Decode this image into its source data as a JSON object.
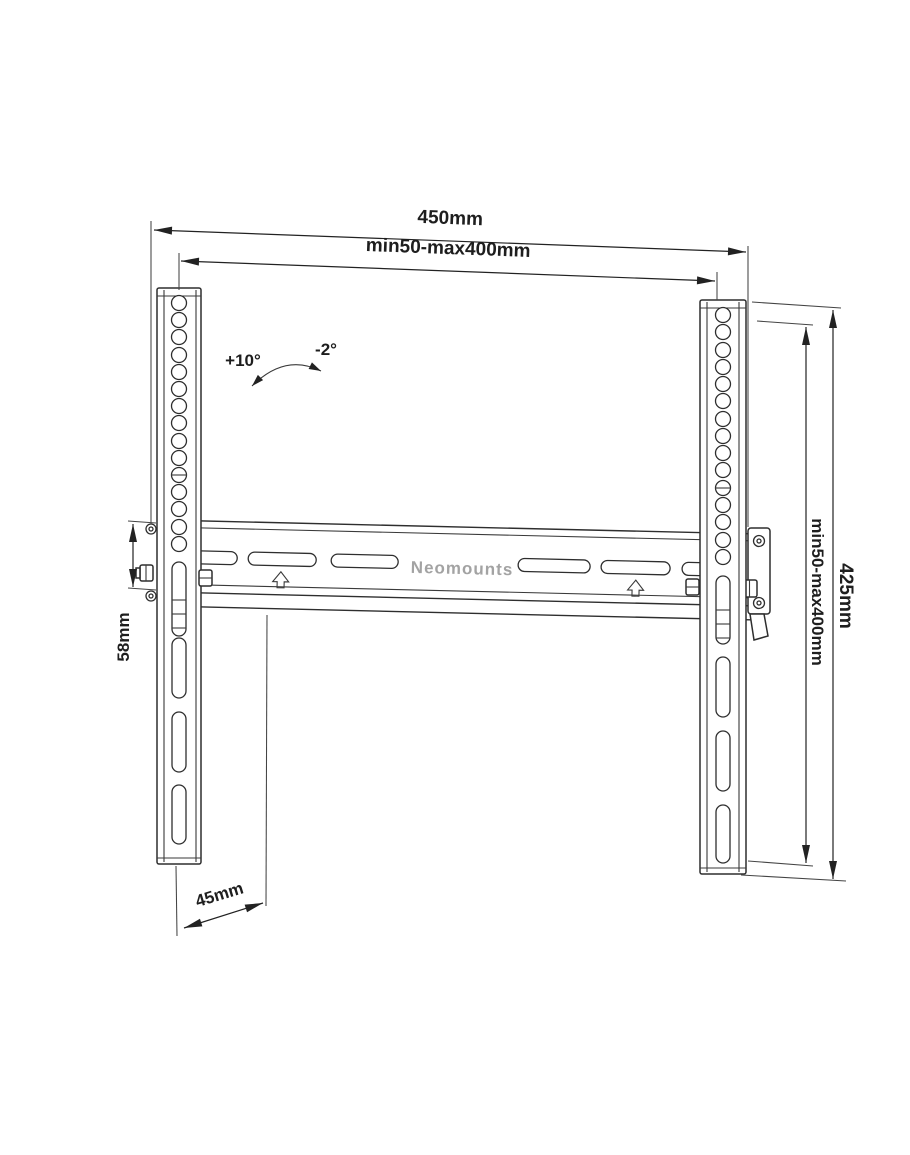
{
  "drawing": {
    "brand_label": "Neomounts",
    "dim_outer_width": "450mm",
    "dim_vesa_width": "min50-max400mm",
    "dim_outer_height": "425mm",
    "dim_vesa_height": "min50-max400mm",
    "dim_rail_height": "58mm",
    "dim_depth": "45mm",
    "tilt_down_label": "+10°",
    "tilt_up_label": "-2°"
  },
  "colors": {
    "background": "#ffffff",
    "line": "#2e2e2e",
    "dimension_text": "#1e1e1e",
    "brand_text": "#a3a3a3"
  }
}
